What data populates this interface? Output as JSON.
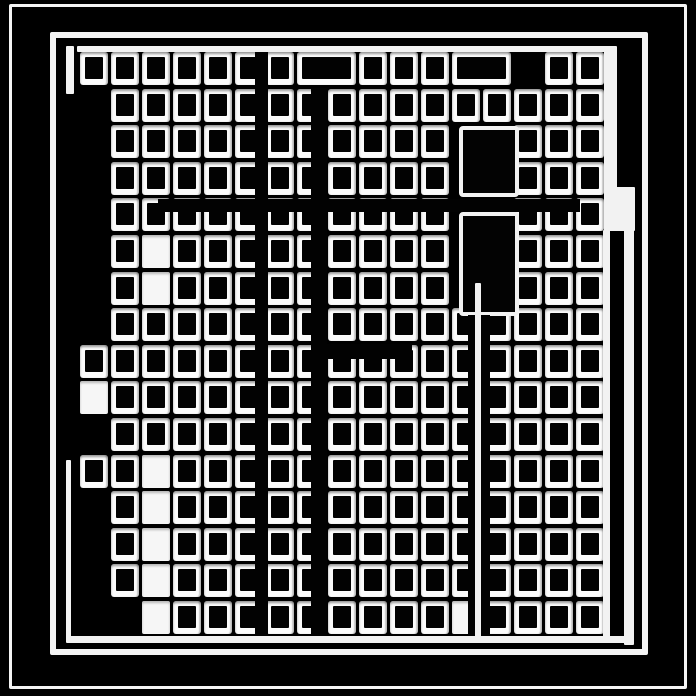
{
  "artwork": {
    "description": "Abstract black-and-white maze-like grid pattern with nested frames, white-framed window cells, black corridor walls and white corridor stripes",
    "palette": {
      "background": "#000000",
      "foreground": "#f4f4f4"
    },
    "canvas": {
      "width": 696,
      "height": 696
    },
    "frames": [
      {
        "name": "outer-frame",
        "x": 9,
        "y": 4,
        "w": 678,
        "h": 685,
        "t": 3
      },
      {
        "name": "inner-frame",
        "x": 50,
        "y": 32,
        "w": 598,
        "h": 623,
        "t": 6
      }
    ],
    "grid": {
      "x0": 80,
      "y0": 52,
      "col_pitch": 31,
      "row_pitch": 36.6,
      "cell_w": 28,
      "cell_h": 33,
      "cols": 17,
      "rows": 16,
      "legend": {
        "0": "black void",
        "1": "framed cell",
        "2": "white corridor cell",
        "3": "wide framed cell spanning 2 columns",
        "9": "consumed by wide cell"
      },
      "cells": [
        "11111113911139011",
        "01111111111111111",
        "01111111111100111",
        "01111111111100111",
        "01111111111100111",
        "01211111111100111",
        "01211111111100111",
        "01111111111111111",
        "11111111111111111",
        "21111111111111111",
        "01111111111111111",
        "11211111111111111",
        "01211111111111111",
        "01211111111111111",
        "01211111111111111",
        "00211111111121111"
      ]
    },
    "black_blocks": [
      {
        "x": 459,
        "y": 126,
        "w": 60,
        "h": 71
      },
      {
        "x": 459,
        "y": 212,
        "w": 60,
        "h": 104
      }
    ],
    "walls": [
      {
        "x": 255,
        "y": 46,
        "w": 13,
        "h": 594
      },
      {
        "x": 311,
        "y": 88,
        "w": 16,
        "h": 552
      },
      {
        "x": 158,
        "y": 199,
        "w": 422,
        "h": 13
      },
      {
        "x": 311,
        "y": 344,
        "w": 101,
        "h": 15
      },
      {
        "x": 468,
        "y": 315,
        "w": 22,
        "h": 325
      }
    ],
    "white_shapes": [
      {
        "x": 77,
        "y": 46,
        "w": 531,
        "h": 6
      },
      {
        "x": 66,
        "y": 636,
        "w": 568,
        "h": 7
      },
      {
        "x": 604,
        "y": 46,
        "w": 13,
        "h": 146
      },
      {
        "x": 604,
        "y": 187,
        "w": 31,
        "h": 44
      },
      {
        "x": 603,
        "y": 230,
        "w": 7,
        "h": 410
      },
      {
        "x": 624,
        "y": 190,
        "w": 10,
        "h": 455
      },
      {
        "x": 66,
        "y": 460,
        "w": 5,
        "h": 180
      },
      {
        "x": 475,
        "y": 283,
        "w": 6,
        "h": 355
      },
      {
        "x": 66,
        "y": 46,
        "w": 8,
        "h": 48
      }
    ]
  }
}
